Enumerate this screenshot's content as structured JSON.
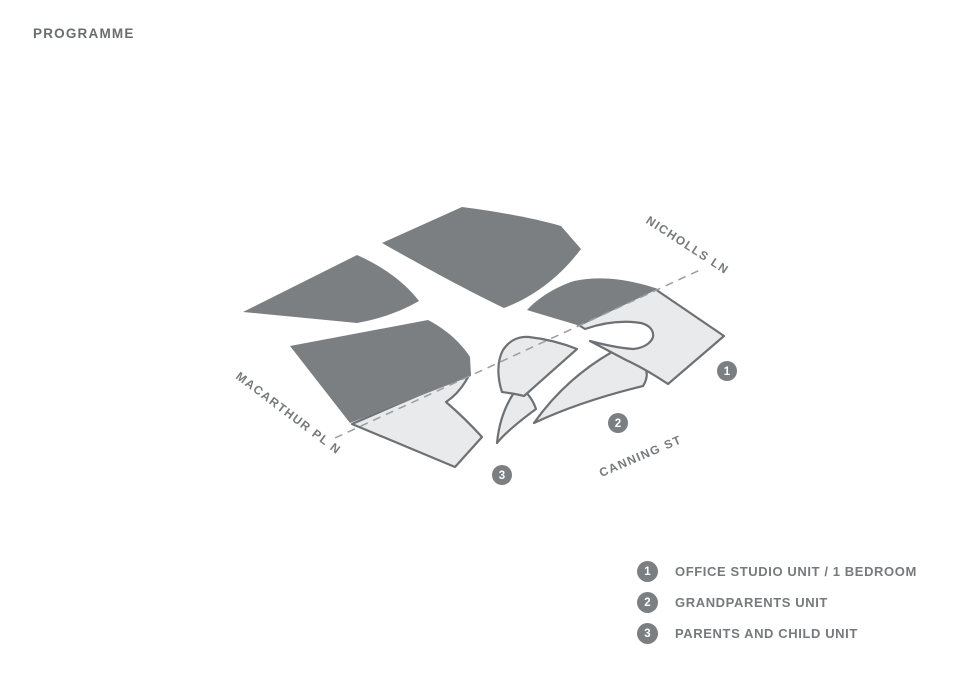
{
  "page": {
    "title": "PROGRAMME"
  },
  "colors": {
    "dark_fill": "#7c7f82",
    "light_fill": "#e9eaeb",
    "outline": "#6e7174",
    "dash": "#9a9da0",
    "text": "#77797c",
    "text_strong": "#6a6d70",
    "marker_text": "#ffffff",
    "bg": "#ffffff"
  },
  "diagram": {
    "streets": [
      {
        "name": "NICHOLLS LN"
      },
      {
        "name": "MACARTHUR PL N"
      },
      {
        "name": "CANNING ST"
      }
    ],
    "markers": [
      {
        "number": "1"
      },
      {
        "number": "2"
      },
      {
        "number": "3"
      }
    ]
  },
  "legend": {
    "items": [
      {
        "number": "1",
        "label": "OFFICE STUDIO UNIT / 1 BEDROOM"
      },
      {
        "number": "2",
        "label": "GRANDPARENTS UNIT"
      },
      {
        "number": "3",
        "label": "PARENTS AND CHILD UNIT"
      }
    ]
  }
}
